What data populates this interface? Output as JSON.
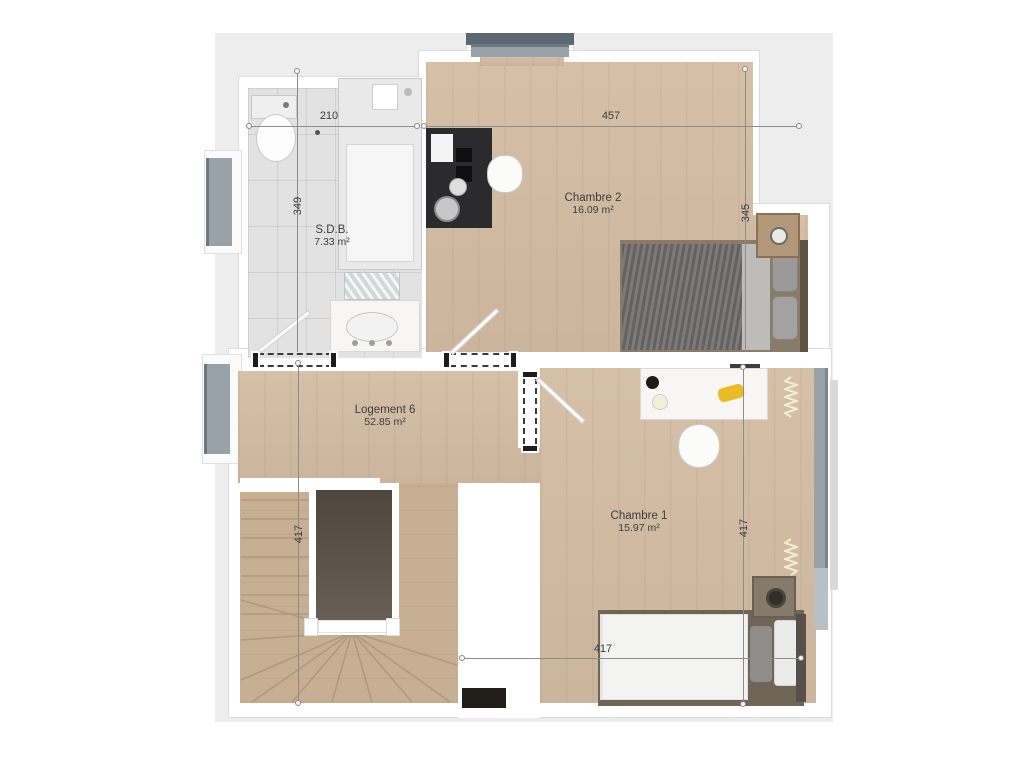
{
  "rooms": {
    "sdb": {
      "name": "S.D.B.",
      "area": "7.33 m²"
    },
    "chambre2": {
      "name": "Chambre 2",
      "area": "16.09 m²"
    },
    "logement6": {
      "name": "Logement 6",
      "area": "52.85 m²"
    },
    "chambre1": {
      "name": "Chambre 1",
      "area": "15.97 m²"
    }
  },
  "dimensions": {
    "bath_width": "210",
    "bath_height": "349",
    "chambre2_width": "457",
    "chambre2_height": "345",
    "stair_height": "417",
    "chambre1_height": "417",
    "chambre1_width": "417"
  },
  "colors": {
    "canvas_gray": "#ededed",
    "wood_floor": "#d3bda3",
    "stair_wood": "#c7af93",
    "tile_gray": "#e2e2e2",
    "window_gray": "#99a1a9",
    "stairwell_dark": "#5f564b",
    "accent_yellow": "#ecba22"
  }
}
